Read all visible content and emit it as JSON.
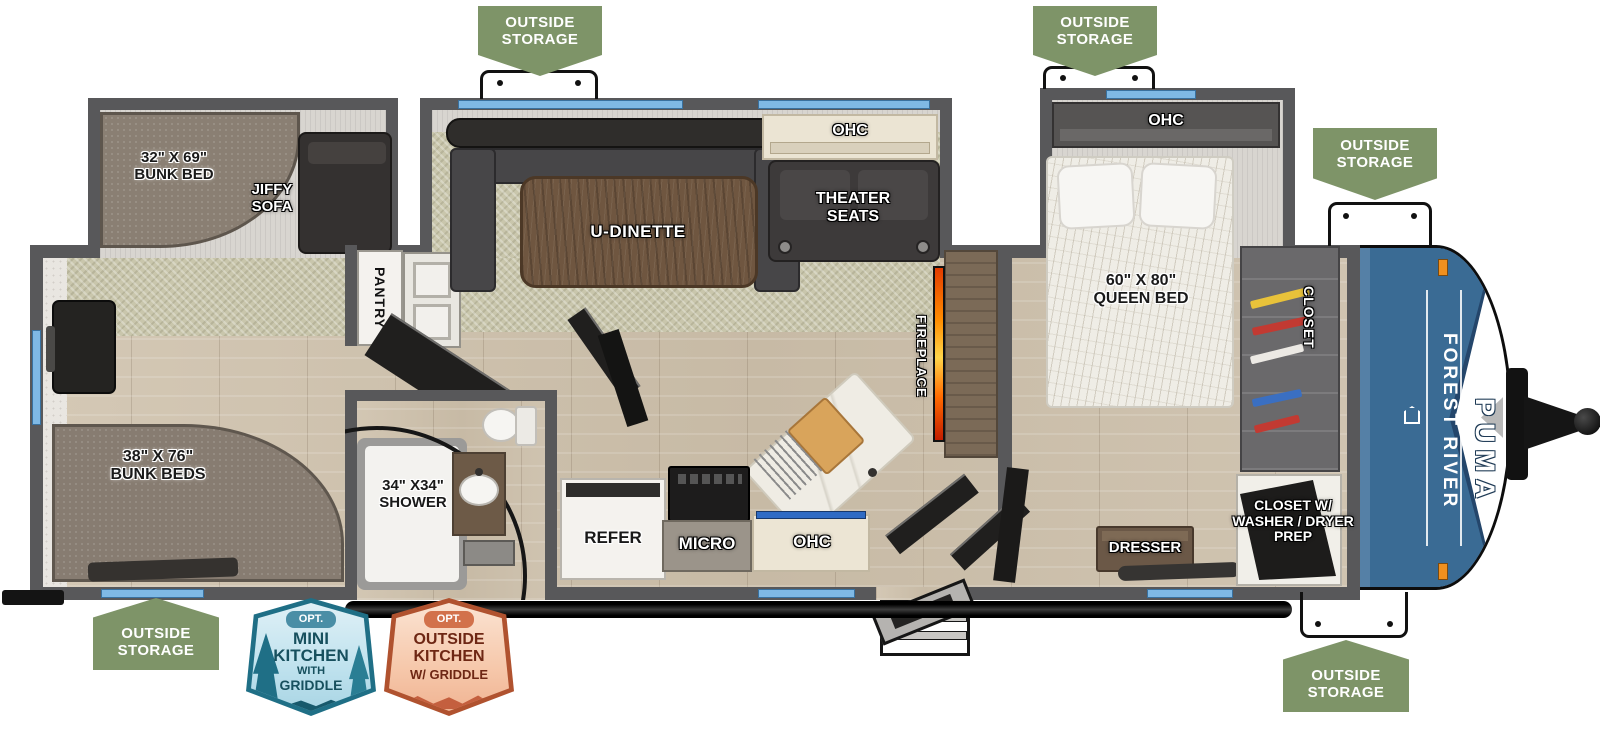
{
  "storage_badge": {
    "line1": "OUTSIDE",
    "line2": "STORAGE"
  },
  "labels": {
    "bunk_slide_dim": "32\" X 69\"",
    "bunk_slide_name": "BUNK BED",
    "jiffy_line1": "JIFFY",
    "jiffy_line2": "SOFA",
    "pantry": "PANTRY",
    "dinette": "U-DINETTE",
    "ohc": "OHC",
    "theater_line1": "THEATER",
    "theater_line2": "SEATS",
    "fireplace": "FIREPLACE",
    "queen_dim": "60\" X 80\"",
    "queen_name": "QUEEN BED",
    "closet": "CLOSET",
    "closet_wd_line1": "CLOSET W/",
    "closet_wd_line2": "WASHER / DRYER",
    "closet_wd_line3": "PREP",
    "dresser": "DRESSER",
    "refer": "REFER",
    "micro": "MICRO",
    "shower_dim": "34\" X34\"",
    "shower_name": "SHOWER",
    "bunks_dim": "38\" X 76\"",
    "bunks_name": "BUNK BEDS"
  },
  "brand": {
    "make": "FOREST RIVER",
    "model": "PUMA"
  },
  "opt_mini": {
    "tag": "OPT.",
    "line1": "MINI",
    "line2": "KITCHEN",
    "line3": "WITH",
    "line4": "GRIDDLE"
  },
  "opt_outside": {
    "tag": "OPT.",
    "line1": "OUTSIDE",
    "line2": "KITCHEN",
    "line3": "W/ GRIDDLE"
  },
  "colors": {
    "badge_green": "#7E9468",
    "window_blue": "#7FB9E5",
    "wall_gray": "#58585A",
    "cap_blue": "#3A6B94",
    "fireplace_orange": "#FF8C00",
    "mini_badge_teal": "#2E7D92",
    "outside_badge_orange": "#C05A38"
  }
}
